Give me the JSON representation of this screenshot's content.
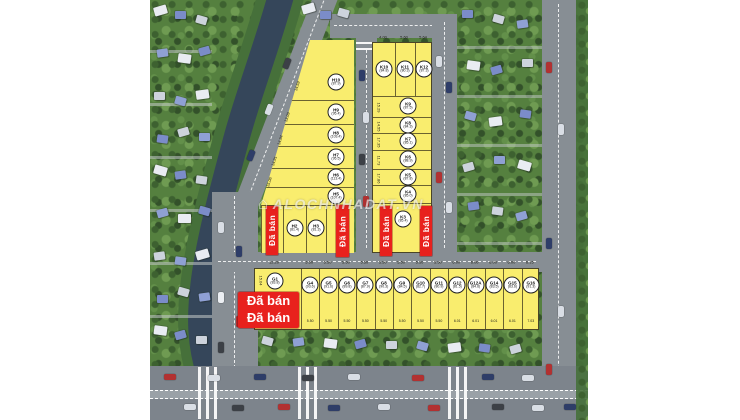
{
  "scene": {
    "type": "real-estate-subdivision-aerial-map",
    "watermark": "ALOCHNHADAT.VN",
    "watermark_icon": "⌂",
    "sold_banner": "Đã bán",
    "sold_box": [
      "Đã bán",
      "Đã bán"
    ]
  },
  "colors": {
    "plot_yellow": "#f9ed6e",
    "sold_red": "#e8211d",
    "road_gray": "#878e94",
    "water": "#35465a",
    "foliage": "#55803f",
    "circle_bg": "#ffffff"
  },
  "plots": {
    "h_column": [
      {
        "id": "H10",
        "area": "(87.9)"
      },
      {
        "id": "H9",
        "area": "(95.4)"
      },
      {
        "id": "H8",
        "area": "(103.4)"
      },
      {
        "id": "H7",
        "area": "(95.5)"
      },
      {
        "id": "H6",
        "area": "(113.4)"
      },
      {
        "id": "H5",
        "area": "(107.4)"
      }
    ],
    "h_bottom_row": [
      {
        "id": "H2",
        "area": "(81.4)"
      },
      {
        "id": "H3",
        "area": "(81.3)"
      }
    ],
    "k_top_row": [
      {
        "id": "K10",
        "area": "(84.8)"
      },
      {
        "id": "K11",
        "area": "(80.3)"
      },
      {
        "id": "K12",
        "area": "(87.3)"
      }
    ],
    "k_column": [
      {
        "id": "K9",
        "area": "(87.5)"
      },
      {
        "id": "K8",
        "area": "(84.3)"
      },
      {
        "id": "K7",
        "area": "(85.1)"
      },
      {
        "id": "K6",
        "area": "(88.9)"
      },
      {
        "id": "K5",
        "area": "(87.8)"
      },
      {
        "id": "K4",
        "area": "(85.0)"
      }
    ],
    "k_bottom": {
      "id": "K3",
      "area": "(85.4)"
    },
    "g1": {
      "id": "G1",
      "area": "(83.8)"
    },
    "g_row": [
      {
        "id": "G4",
        "area": "(93.6)"
      },
      {
        "id": "G5",
        "area": "(91.6)"
      },
      {
        "id": "G6",
        "area": "(89.8)"
      },
      {
        "id": "G7",
        "area": "(87.9)"
      },
      {
        "id": "G8",
        "area": "(90.3)"
      },
      {
        "id": "G9",
        "area": "(84.5)"
      },
      {
        "id": "G10",
        "area": "(82.7)"
      },
      {
        "id": "G11",
        "area": "(80.9)"
      },
      {
        "id": "G12",
        "area": "(81.5)"
      },
      {
        "id": "G12A",
        "area": "(84.6)"
      },
      {
        "id": "G14",
        "area": "(83.5)"
      },
      {
        "id": "G15",
        "area": "(83.6)"
      },
      {
        "id": "G16",
        "area": "(91.3)"
      }
    ]
  },
  "dimensions": {
    "h_left": [
      "14.59",
      "13.09",
      "14.94",
      "14.91",
      "15.06"
    ],
    "k_top": [
      "4.00",
      "5.60",
      "5.64"
    ],
    "k_left": [
      "15.29",
      "14.55",
      "17.35",
      "11.73",
      "17.86"
    ],
    "g_top": [
      "5.50",
      "5.50",
      "5.50",
      "5.50",
      "5.50",
      "5.50",
      "5.50",
      "5.50",
      "6.00",
      "6.00",
      "6.00",
      "6.00",
      "6.15"
    ],
    "g_bottom": [
      "5.50",
      "5.50",
      "5.50",
      "5.50",
      "5.50",
      "5.50",
      "5.50",
      "5.50",
      "6.01",
      "6.01",
      "6.01",
      "6.01",
      "7.03"
    ],
    "g1_top": "12.29",
    "g1_left": "15.04"
  }
}
